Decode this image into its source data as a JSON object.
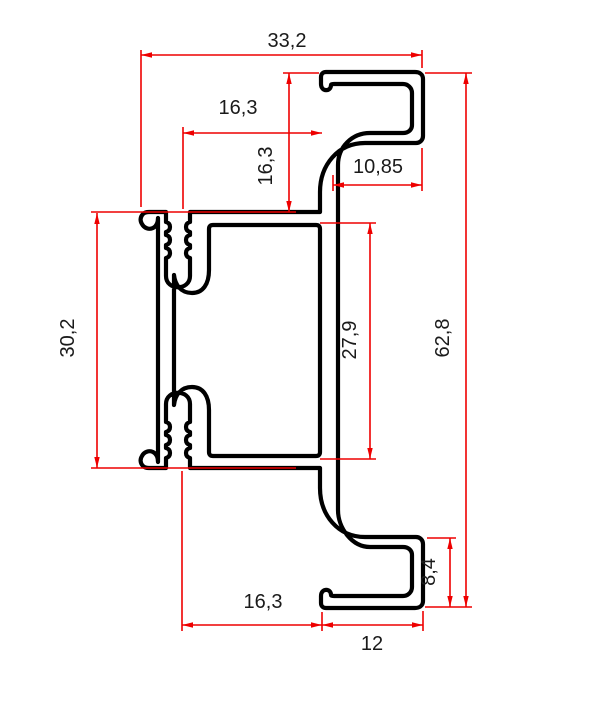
{
  "drawing": {
    "type": "profile-cross-section-technical-drawing",
    "background": "#ffffff",
    "outline_color": "#000000",
    "dimension_color": "#ee0000",
    "label_color": "#1a1a1a",
    "dimensions": {
      "top_width": "33,2",
      "upper_offset": "16,3",
      "upper_height": "16,3",
      "hook_top_width": "10,85",
      "body_height": "30,2",
      "inner_height": "27,9",
      "total_height": "62,8",
      "hook_bottom_height": "8,4",
      "bottom_offset": "16,3",
      "hook_bottom_width": "12"
    }
  }
}
